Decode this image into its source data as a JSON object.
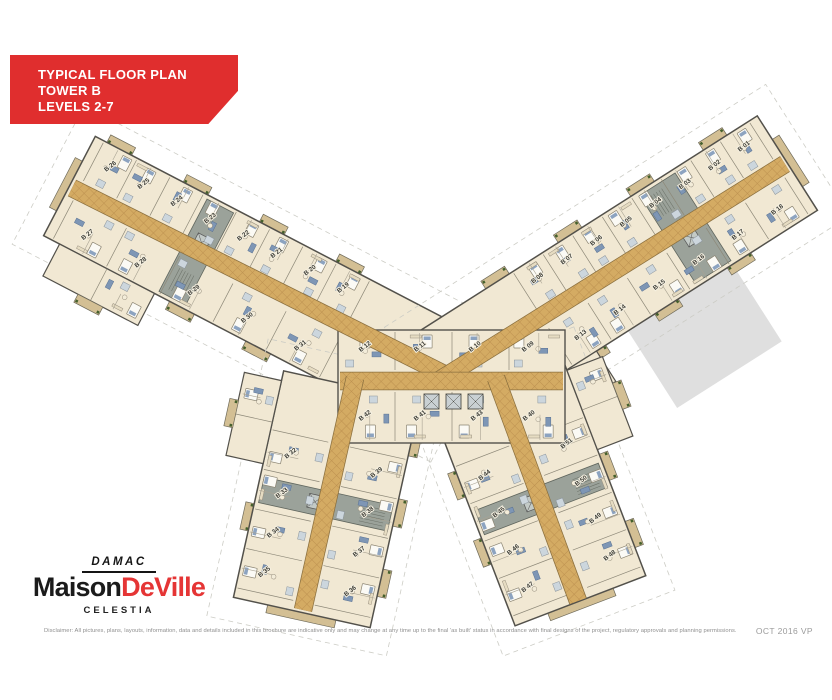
{
  "banner": {
    "line1": "TYPICAL FLOOR PLAN",
    "line2": "TOWER B",
    "line3": "LEVELS 2-7",
    "bg_color": "#e02e2e",
    "text_color": "#ffffff"
  },
  "logo": {
    "brand": "DAMAC",
    "name_black": "Maison",
    "name_red": "DeVille",
    "subtitle": "CELESTIA",
    "red": "#e53535",
    "black": "#1b1b1b"
  },
  "footer": {
    "disclaimer": "Disclaimer: All pictures, plans, layouts, information, data and details included in this brochure are indicative only and may change at any time up to the final 'as built' status in accordance with final designs of the project, regulatory approvals and planning permissions.",
    "date_code": "OCT 2016 VP"
  },
  "floor_plan": {
    "colors": {
      "room": "#f1e8d3",
      "corridor": "#d4ab63",
      "corridor_line": "#bd9150",
      "corridor_edge": "#8a6f3e",
      "wall": "#53514b",
      "partition": "#8d8878",
      "balcony": "#d3bf94",
      "furniture_blue": "#7e96b5",
      "bed_white": "#fbfaf5",
      "bath": "#ccd6dd",
      "core_gray": "#9ba29a",
      "plant_green": "#44602c",
      "shadow": "#dbdbdb",
      "boundary_dash": "#ccccc5",
      "label": "#3e3e38"
    },
    "wings": {
      "upper_left": {
        "side_top": [
          "B 19",
          "B 20",
          "B 21",
          "B 22",
          "B 23",
          "B 24",
          "B 25",
          "B 26"
        ],
        "side_bottom": [
          "B 31",
          "B 30",
          "B 29",
          "B 28",
          "B 27"
        ]
      },
      "upper_right": {
        "side_top": [
          "B 08",
          "B 07",
          "B 06",
          "B 05",
          "B 04",
          "B 03",
          "B 02",
          "B 01"
        ],
        "side_bottom": [
          "B 13",
          "B 14",
          "B 15",
          "B 16",
          "B 17",
          "B 18"
        ]
      },
      "lower_left": {
        "side_left": [
          "B 32",
          "B 33",
          "B 34",
          "B 35"
        ],
        "side_right": [
          "B 39",
          "B 38",
          "B 37",
          "B 36"
        ]
      },
      "lower_right": {
        "side_left": [
          "B 44",
          "B 45",
          "B 46",
          "B 47"
        ],
        "side_right": [
          "B 51",
          "B 50",
          "B 49",
          "B 48"
        ]
      },
      "core_top": [
        "B 12",
        "B 11",
        "B 10",
        "B 09"
      ],
      "core_bottom": [
        "B 42",
        "B 41",
        "B 43",
        "B 40"
      ]
    }
  }
}
